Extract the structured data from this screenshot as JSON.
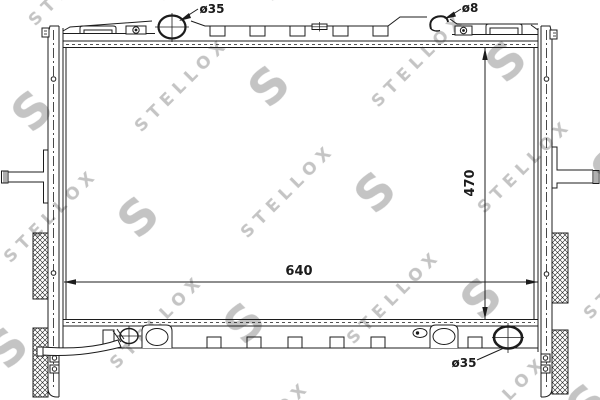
{
  "drawing": {
    "watermark_text": "STELLOX",
    "watermark_logo": "S",
    "labels": {
      "filler_diameter": "ø35",
      "overflow_diameter": "ø8",
      "core_height": "470",
      "core_width": "640",
      "outlet_diameter": "ø35"
    },
    "icons": {
      "filler_neck": "filler-neck-circle-crosshair",
      "drain_plug": "drain-plug-circle-crosshair",
      "outlet": "outlet-circle-crosshair"
    },
    "colors": {
      "line": "#1c1c1c",
      "watermark": "#c4c4c4",
      "background": "#ffffff"
    }
  }
}
